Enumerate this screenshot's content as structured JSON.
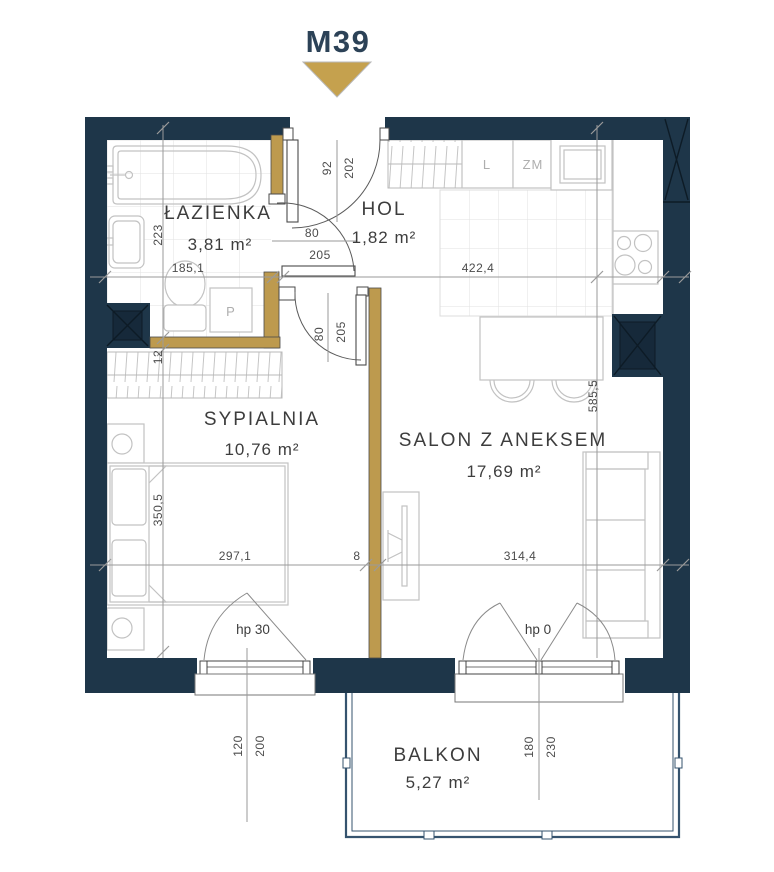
{
  "header": {
    "unit": "M39"
  },
  "colors": {
    "wall": "#1e3649",
    "partition_gold": "#bd9a4e",
    "accent_triangle": "#c5a14e",
    "furniture_line": "#c2c2c2",
    "dimension_line": "#9a9a9a",
    "label_text": "#3d3d3d"
  },
  "rooms": {
    "lazienka": {
      "name": "ŁAZIENKA",
      "area": "3,81 m²"
    },
    "hol": {
      "name": "HOL",
      "area": "1,82 m²"
    },
    "sypialnia": {
      "name": "SYPIALNIA",
      "area": "10,76 m²"
    },
    "salon": {
      "name": "SALON Z ANEKSEM",
      "area": "17,69 m²"
    },
    "balkon": {
      "name": "BALKON",
      "area": "5,27 m²"
    }
  },
  "appliances": {
    "fridge": "L",
    "dishwasher": "ZM",
    "washer": "P"
  },
  "dims": {
    "bath_w": "185,1",
    "bath_h": "223",
    "w12": "12",
    "bed_w": "297,1",
    "bed_h": "350,5",
    "w8": "8",
    "salon_w": "314,4",
    "kit_w": "422,4",
    "salon_h": "585,5",
    "entry_w": "92",
    "entry_h": "202",
    "door_w": "80",
    "door_h": "205",
    "door2_w": "80",
    "door2_h": "205",
    "win1_w": "120",
    "win1_h": "200",
    "win1_hp": "hp 30",
    "win2_w": "180",
    "win2_h": "230",
    "win2_hp": "hp 0"
  }
}
